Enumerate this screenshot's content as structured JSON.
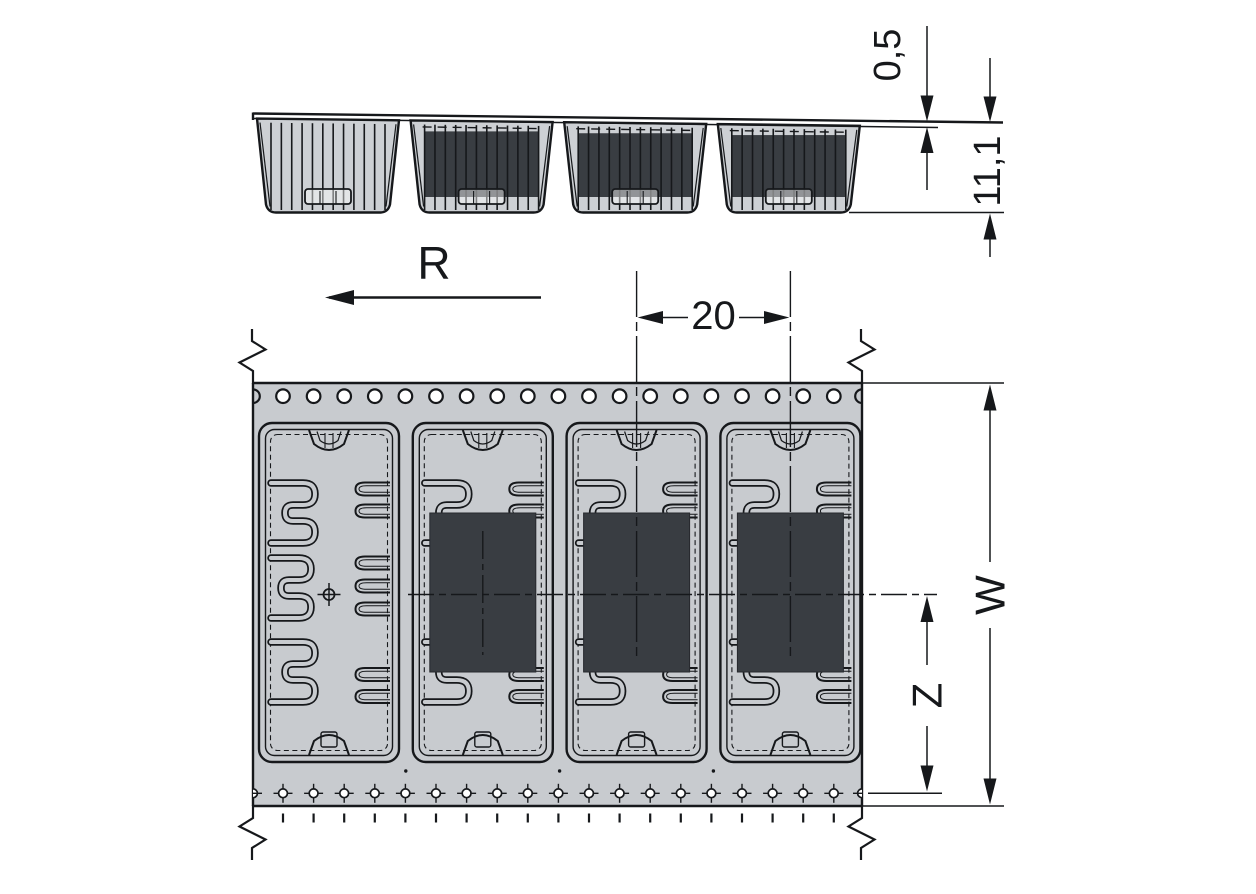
{
  "drawing": {
    "description": "Carrier tape packaging drawing with side view and top view",
    "direction_label": "R",
    "dimensions": {
      "pocket_pitch": "20",
      "cover_tape_thickness": "0,5",
      "pocket_depth": "11,1",
      "tape_width_label": "W",
      "hole_centerline_distance_label": "Z"
    },
    "side_view": {
      "pocket_count": 4,
      "pockets_occupied": [
        false,
        true,
        true,
        true
      ]
    },
    "top_view": {
      "pocket_count": 4,
      "pockets_occupied": [
        false,
        true,
        true,
        true
      ],
      "sprocket_hole_count": 19,
      "index_hole_count": 19,
      "tick_mark_count": 19
    },
    "colors": {
      "tape": "#c8cbcf",
      "component": "#393d42",
      "line": "#16181b",
      "background": "#ffffff"
    }
  }
}
